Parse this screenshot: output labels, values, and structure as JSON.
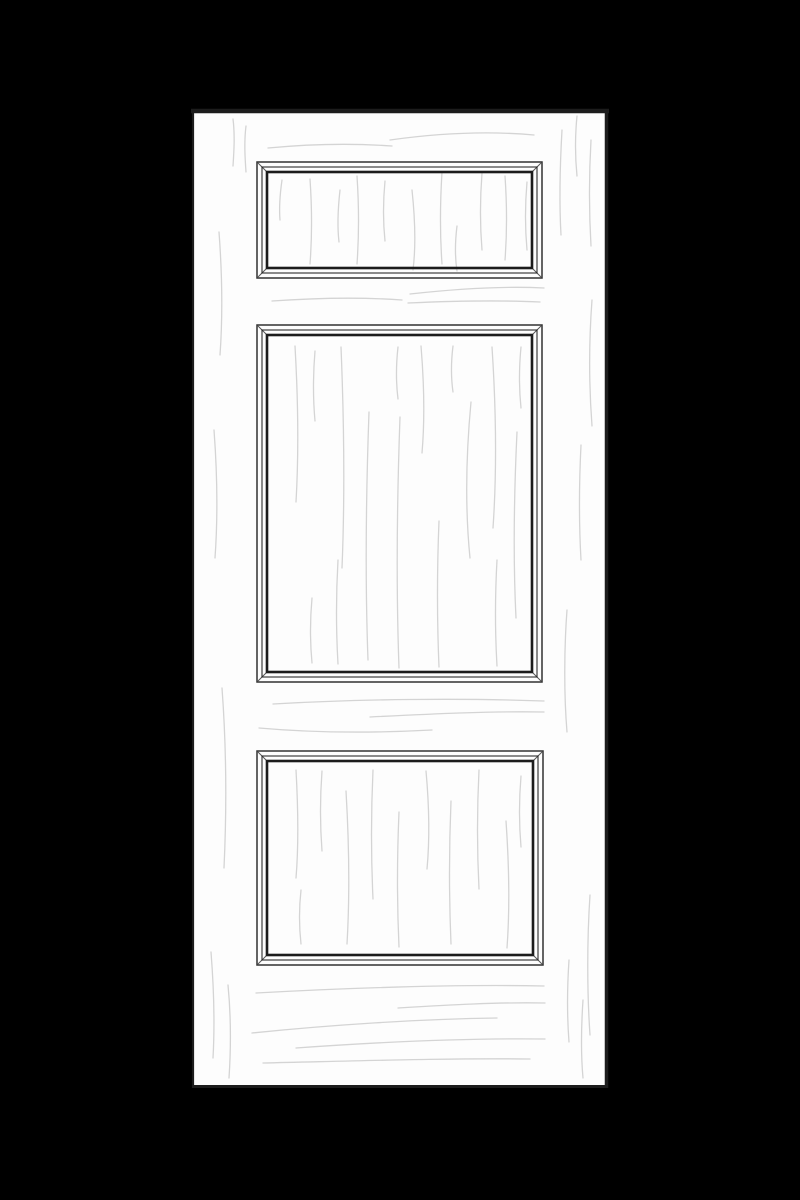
{
  "scene": {
    "description": "Black-and-white line illustration of a three-panel interior door with faint wood grain strokes, centered on a solid black background",
    "background_color": "#000000",
    "door": {
      "fill_color": "#fdfdfd",
      "outline_color": "#1c1c1c",
      "grain_color": "#d4d4d4",
      "panel_count": 3,
      "panels": [
        {
          "id": "top-panel",
          "shape": "rectangle",
          "aspect": "landscape"
        },
        {
          "id": "middle-panel",
          "shape": "rectangle",
          "aspect": "portrait"
        },
        {
          "id": "bottom-panel",
          "shape": "rectangle",
          "aspect": "landscape"
        }
      ]
    }
  }
}
